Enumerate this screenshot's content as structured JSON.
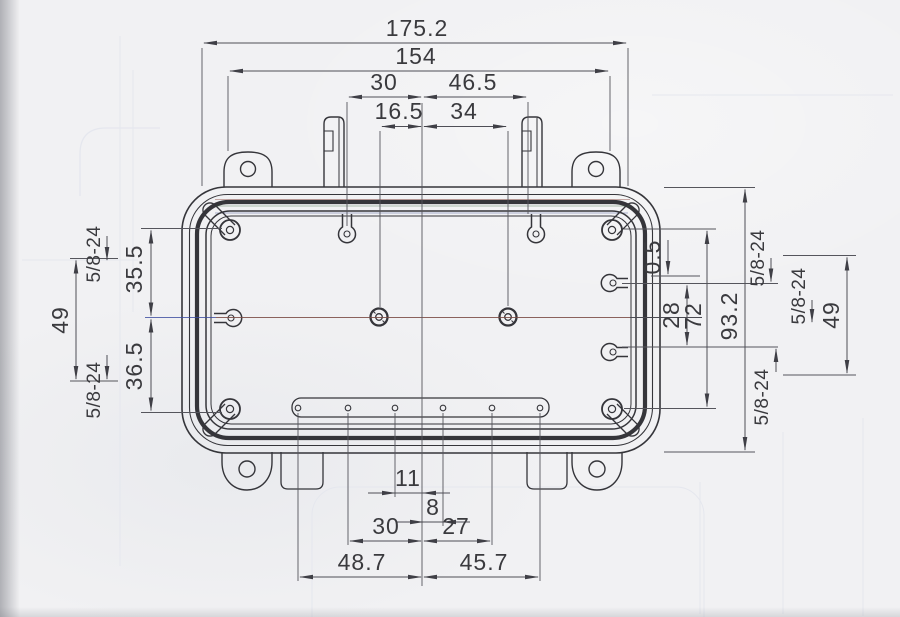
{
  "document": {
    "kind": "scanned engineering dimension drawing of a rectangular enclosure (interior face view)"
  },
  "dimensions": {
    "top": {
      "overall_width": "175.2",
      "ear_span": "154",
      "boss_left_to_center": "30",
      "center_to_boss_right": "46.5",
      "hole_left_to_center": "16.5",
      "center_to_hole_right": "34"
    },
    "bottom": {
      "hole3_to_center": "11",
      "center_to_hole4": "8",
      "hole2_to_center": "30",
      "center_to_hole5": "27",
      "hole1_to_center": "48.7",
      "center_to_hole6": "45.7"
    },
    "left": {
      "thread_top": "5/8-24",
      "screw_to_centerline": "35.5",
      "side_holes_span": "49",
      "thread_bottom": "5/8-24",
      "centerline_to_screw": "36.5"
    },
    "right": {
      "boss_offset": "0.5",
      "boss_span": "28",
      "screw_span": "72",
      "overall_height": "93.2",
      "thread_top": "5/8-24",
      "thread_outer": "5/8-24",
      "thread_bottom": "5/8-24",
      "side_holes_span": "49"
    }
  },
  "colors": {
    "paper": "#f1f1f3",
    "ink": "#35353a",
    "dimension_line": "#4e4e56",
    "seal_band": "#2b2b2e",
    "ghost_bleedthrough": "#e5e7ee"
  }
}
